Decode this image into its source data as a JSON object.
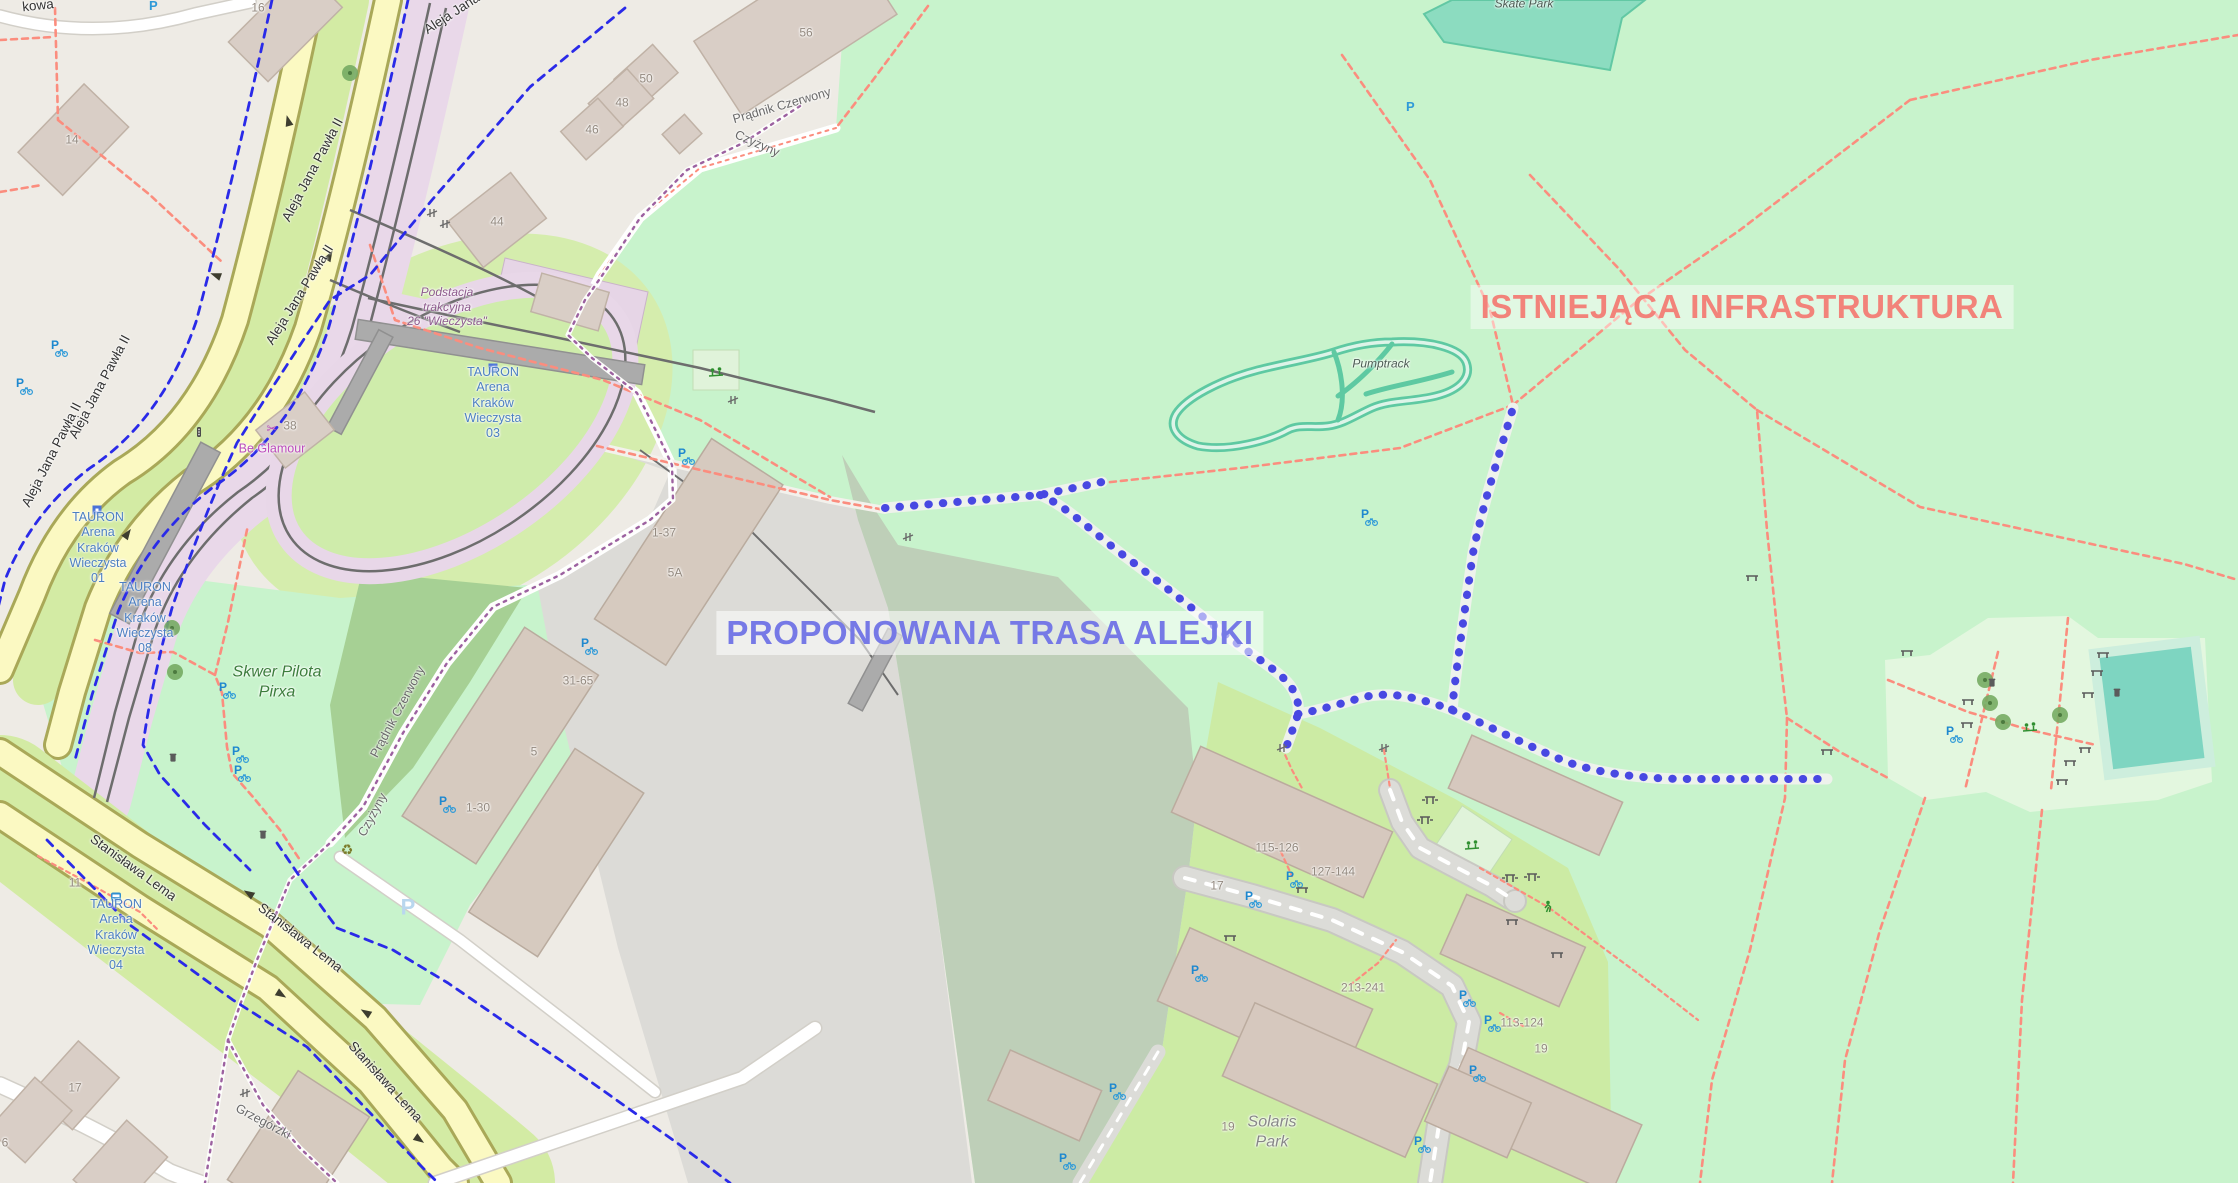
{
  "overlay": {
    "proposed": "PROPONOWANA TRASA ALEJKI",
    "existing": "ISTNIEJĄCA INFRASTRUKTURA"
  },
  "icons": {
    "p": "P",
    "recycle": "♻",
    "shop": "✂"
  },
  "street_labels": [
    {
      "text": "kowa"
    },
    {
      "text": "Aleja Jana"
    },
    {
      "text": "Aleja Jana Pawła II"
    },
    {
      "text": "Aleja Jana Pawła II"
    },
    {
      "text": "Aleja Jana Pawła II"
    },
    {
      "text": "Aleja Jana Pawła II"
    },
    {
      "text": "Stanisława Lema"
    },
    {
      "text": "Stanisława Lema"
    },
    {
      "text": "Stanisława Lema"
    }
  ],
  "boundary_labels": [
    {
      "text": "Prądnik Czerwony"
    },
    {
      "text": "Czyżyny"
    },
    {
      "text": "Prądnik Czerwony"
    },
    {
      "text": "Czyżyny"
    },
    {
      "text": "Grzegórzki"
    }
  ],
  "building_labels": [
    {
      "text": "16"
    },
    {
      "text": "14"
    },
    {
      "text": "56"
    },
    {
      "text": "50"
    },
    {
      "text": "48"
    },
    {
      "text": "46"
    },
    {
      "text": "44"
    },
    {
      "text": "38"
    },
    {
      "text": "1-37"
    },
    {
      "text": "5A"
    },
    {
      "text": "31-65"
    },
    {
      "text": "5"
    },
    {
      "text": "1-30"
    },
    {
      "text": "115-126"
    },
    {
      "text": "127-144"
    },
    {
      "text": "17"
    },
    {
      "text": "213-241"
    },
    {
      "text": "113-124"
    },
    {
      "text": "19"
    },
    {
      "text": "19"
    },
    {
      "text": "17"
    },
    {
      "text": "11"
    },
    {
      "text": "6"
    }
  ],
  "transit_labels": [
    {
      "text": "TAURON\nArena\nKraków\nWieczysta\n01"
    },
    {
      "text": "TAURON\nArena\nKraków\nWieczysta\n08"
    },
    {
      "text": "TAURON\nArena\nKraków\nWieczysta\n03"
    },
    {
      "text": "TAURON\nArena\nKraków\nWieczysta\n04"
    }
  ],
  "place_labels": [
    {
      "text": "Skwer Pilota\nPirxa"
    },
    {
      "text": "Solaris\nPark"
    },
    {
      "text": "Pumptrack"
    },
    {
      "text": "Skate Park"
    },
    {
      "text": "Podstacja\ntrakcyjna\n26 \"Wieczysta\""
    },
    {
      "text": "Be Glamour"
    }
  ],
  "colors": {
    "proposed_route_blue": "#4848e2",
    "existing_text_red": "#f2837a",
    "bike_route_blue": "#2a2ae8",
    "path_red": "#fb8d7e",
    "boundary_purple": "#9c61a0",
    "green_area": "#c8f3cc",
    "scrub_area": "#becfb8",
    "road_yellow": "#fbf9c2",
    "tram_pink": "#e9d8e9",
    "pumptrack_teal": "#5ec9a2",
    "transit_label_blue": "#4c7fc2"
  }
}
